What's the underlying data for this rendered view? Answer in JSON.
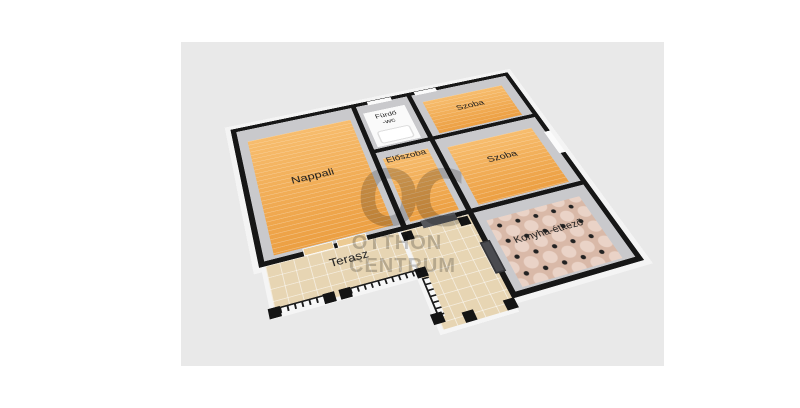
{
  "watermark": {
    "logo": "OC",
    "line1": "OTTHON",
    "line2": "CENTRUM",
    "color": "#7f7f7f"
  },
  "rooms": {
    "nappali": {
      "label": "Nappali",
      "floor": "wood"
    },
    "furdo": {
      "label_line1": "Fürdő",
      "label_line2": "-wc",
      "floor": "white"
    },
    "szoba1": {
      "label": "Szoba",
      "floor": "wood"
    },
    "eloszoba": {
      "label": "Előszoba",
      "floor": "wood"
    },
    "szoba2": {
      "label": "Szoba",
      "floor": "wood"
    },
    "konyha": {
      "label": "Konyha-étkező",
      "floor": "octagon-dot-tile"
    },
    "terasz": {
      "label": "Terasz",
      "floor": "paving"
    }
  },
  "colors": {
    "canvas_bg": "#e9e9e9",
    "wall": "#161616",
    "wall_inner": "#c9c9cc",
    "wood_floor": "#f0a74e",
    "kitchen_tile": "#d9b9a8",
    "terrace_paving": "#e7d5b3",
    "exterior_shell": "#f4f4f4"
  }
}
